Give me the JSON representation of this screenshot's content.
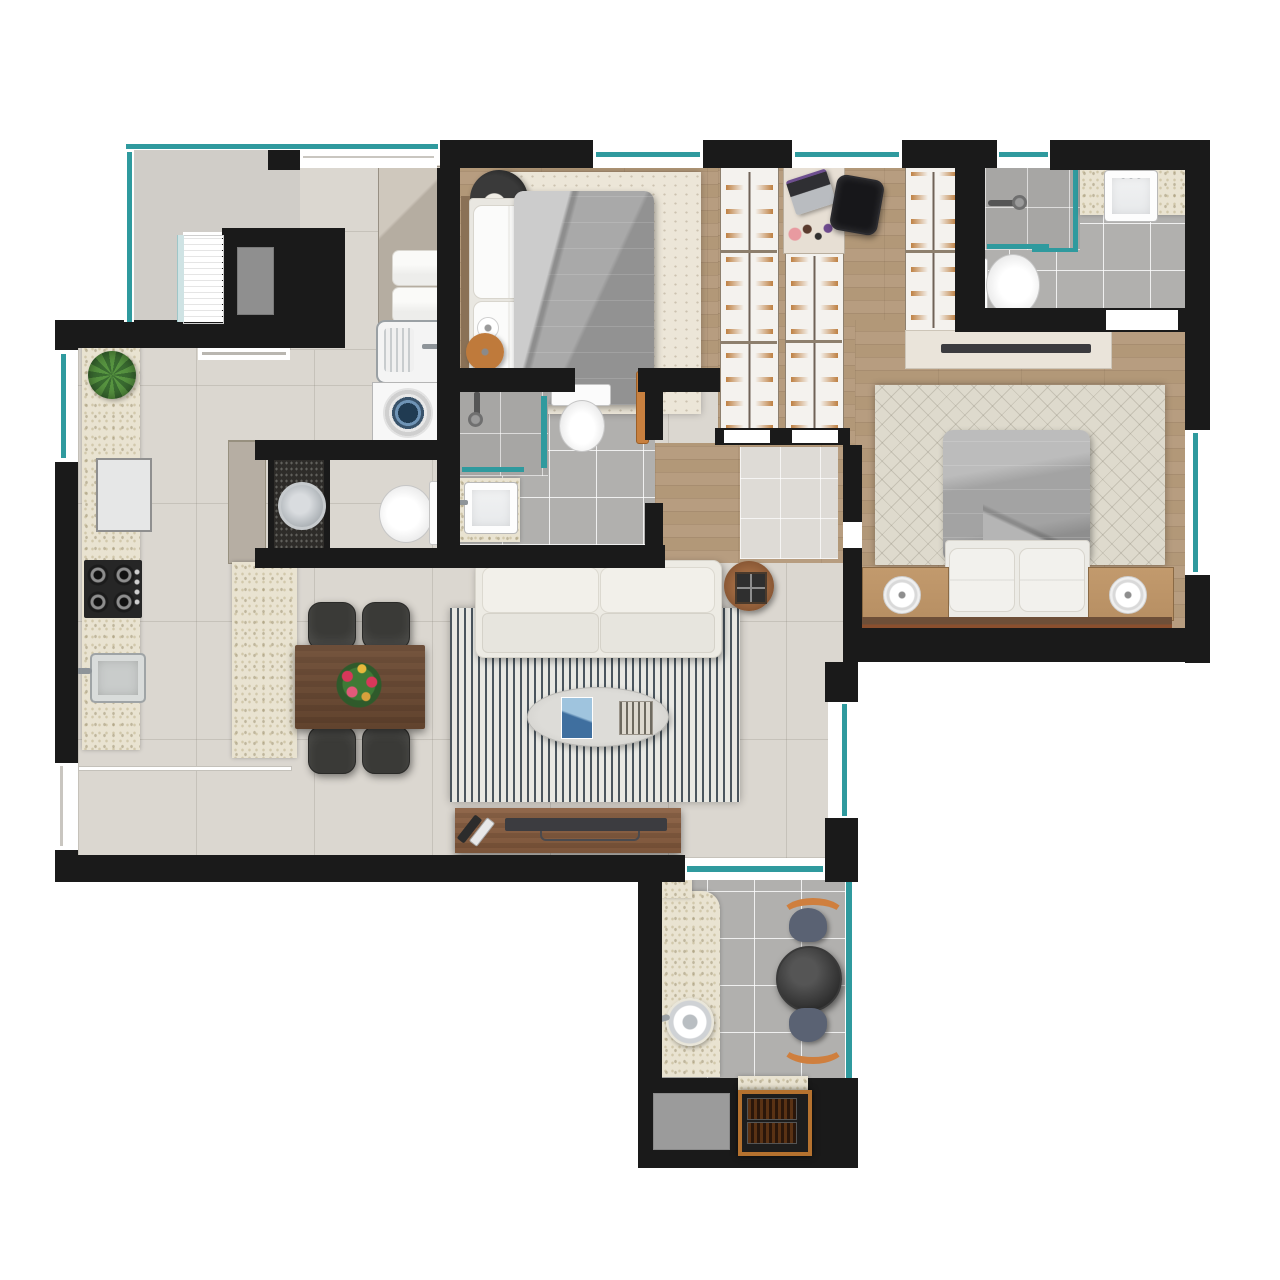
{
  "title": "Apartment floor plan (top-down furnished render)",
  "colors": {
    "wall": "#1a1a1a",
    "glass": "#2f9a9e",
    "tileFloor": "#dbd7d0",
    "bathTile": "#b1b0ae",
    "stone": "#e9e3d1",
    "granite": "#2e2c29",
    "woodFloor": "#b29878",
    "furnitureWood": "#6e4c34",
    "accentOrange": "#c8803f",
    "sofaCream": "#edebe4",
    "duvetGray": "#9e9e9e"
  },
  "rooms": [
    {
      "id": "building-core",
      "label": "building core",
      "contents": [
        "stairs",
        "elevator",
        "entry-hall"
      ]
    },
    {
      "id": "kitchen",
      "label": "kitchen",
      "contents": [
        "stone-counter",
        "potted-plant",
        "refrigerator",
        "cooktop-4-burner",
        "kitchen-sink",
        "island-counter",
        "tall-cabinet"
      ]
    },
    {
      "id": "laundry",
      "label": "laundry",
      "contents": [
        "cabinet-with-towels",
        "utility-sink",
        "washing-machine"
      ]
    },
    {
      "id": "bedroom-1",
      "label": "bedroom 1",
      "contents": [
        "double-bed-gray-duvet",
        "cream-rug",
        "pendant-lamp",
        "round-side-table",
        "table-lamp",
        "swing-door"
      ]
    },
    {
      "id": "closet-office",
      "label": "walk-in closet / office",
      "contents": [
        "wardrobe-left",
        "wardrobe-middle",
        "wardrobe-right",
        "desk",
        "laptop",
        "makeup-set",
        "office-chair"
      ]
    },
    {
      "id": "ensuite-bathroom",
      "label": "en-suite bathroom",
      "contents": [
        "shower",
        "glass-partition",
        "vanity-sink",
        "toilet"
      ]
    },
    {
      "id": "master-bedroom",
      "label": "master bedroom",
      "contents": [
        "tv-console",
        "patterned-rug",
        "double-bed-gray-duvet",
        "nightstand-left",
        "nightstand-right",
        "table-lamps",
        "headboard"
      ]
    },
    {
      "id": "social-bathroom",
      "label": "bathroom",
      "contents": [
        "shower",
        "glass-partition",
        "toilet",
        "vanity-sink",
        "swing-door"
      ]
    },
    {
      "id": "powder-room",
      "label": "powder room",
      "contents": [
        "dark-granite-counter",
        "round-vessel-sink",
        "toilet"
      ]
    },
    {
      "id": "living-dining",
      "label": "living / dining",
      "contents": [
        "dining-table",
        "four-chairs",
        "flower-centerpiece",
        "striped-rug",
        "sofa",
        "oval-coffee-table",
        "books",
        "decor-tray",
        "tv-console",
        "tv",
        "remote-controls",
        "round-side-table"
      ]
    },
    {
      "id": "balcony",
      "label": "gourmet balcony",
      "contents": [
        "stone-counter",
        "round-sink",
        "bistro-table",
        "two-chairs",
        "storage-box",
        "barbecue-grill"
      ]
    }
  ],
  "windows": [
    "top-window-1",
    "top-window-2",
    "top-window-3",
    "right-bathroom-window",
    "master-bedroom-window",
    "living-room-window",
    "kitchen-window",
    "living-left-window",
    "balcony-sliding-door",
    "balcony-glass-railing",
    "core-corner-window"
  ]
}
